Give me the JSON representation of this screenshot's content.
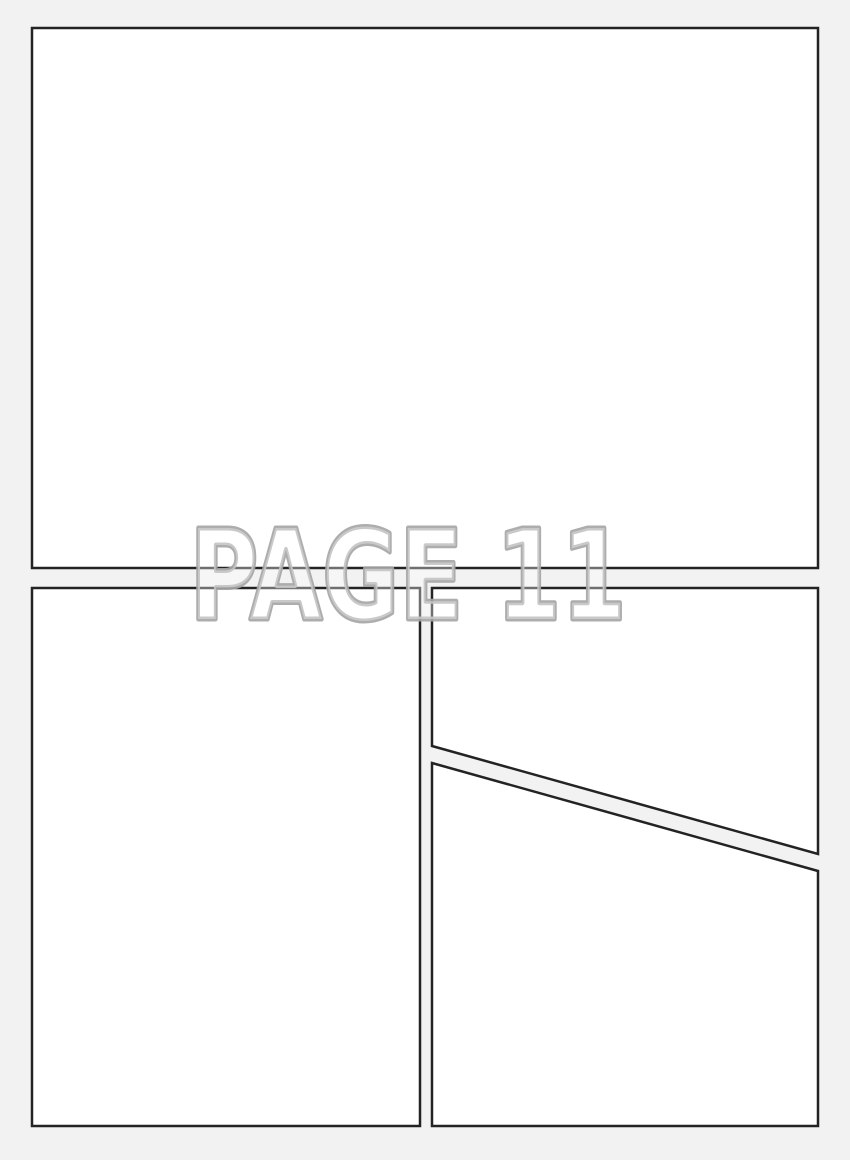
{
  "page": {
    "watermark": "PAGE 11"
  },
  "panels": [
    {
      "id": "panel-top"
    },
    {
      "id": "panel-bottom-left"
    },
    {
      "id": "panel-bottom-right-upper"
    },
    {
      "id": "panel-bottom-right-lower"
    }
  ],
  "colors": {
    "page_background": "#f2f2f2",
    "panel_fill": "#ffffff",
    "panel_border": "#232323",
    "watermark_stroke": "#a6a6a6",
    "watermark_fill": "#ffffff"
  }
}
